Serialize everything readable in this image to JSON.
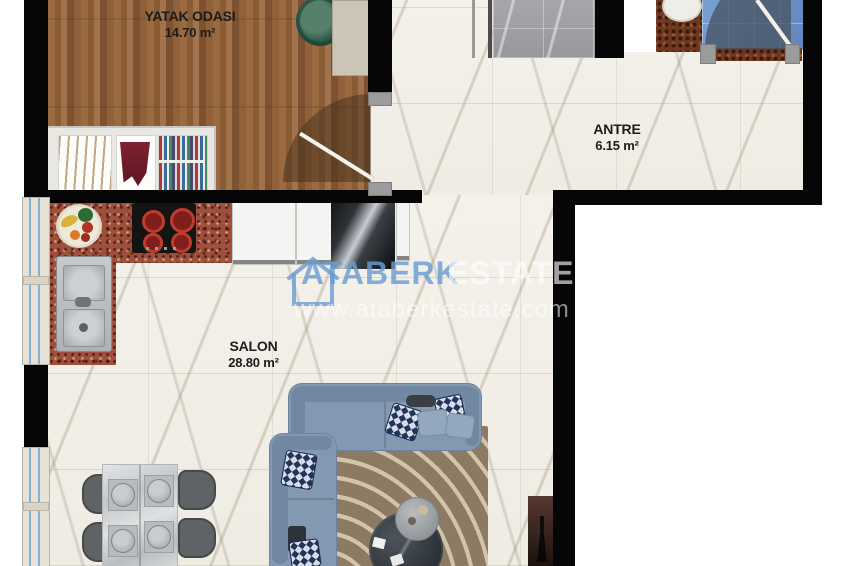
{
  "rooms": {
    "bedroom": {
      "name": "YATAK ODASI",
      "area": "14.70 m²"
    },
    "entry": {
      "name": "ANTRE",
      "area": "6.15 m²"
    },
    "living": {
      "name": "SALON",
      "area": "28.80 m²"
    }
  },
  "watermark": {
    "brand": "ATABERK",
    "brand_secondary": "ESTATE",
    "website": "www.ataberkestate.com"
  },
  "colors": {
    "wall": "#060606",
    "wood_floor": "#8a5c36",
    "marble_floor": "#f2efe8",
    "granite_counter": "#a04f3a",
    "bathroom_floor": "#6f94c8",
    "shower_tile": "#9e9ea3",
    "sofa": "#8398b1",
    "rug": "#8c7b62",
    "watermark_blue": "#6a9cd2"
  }
}
